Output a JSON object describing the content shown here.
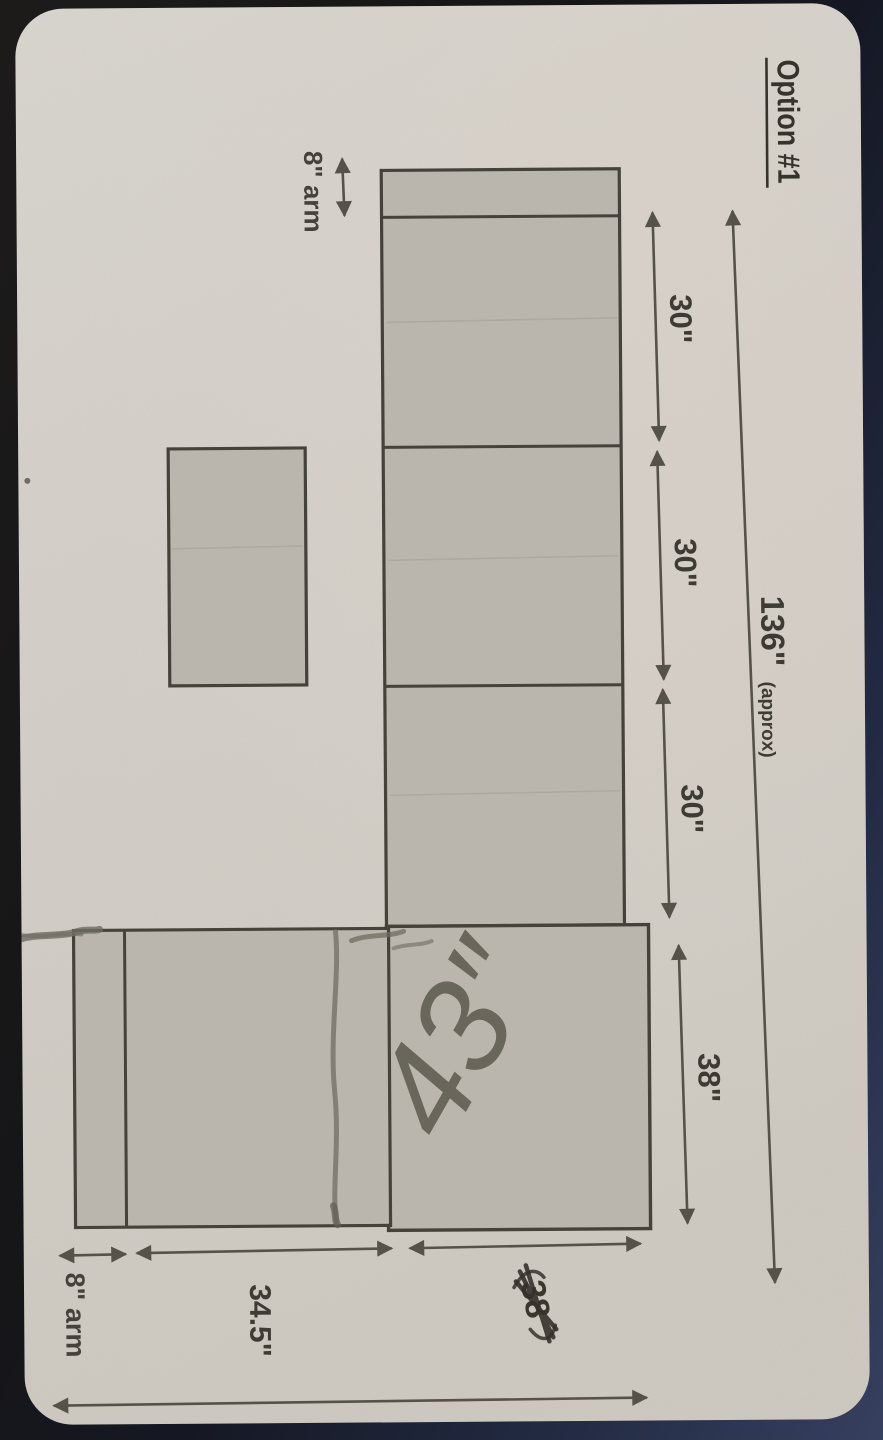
{
  "photo": {
    "title": "Option #1",
    "dimensions": {
      "arm_top": "8\" arm",
      "sections": [
        {
          "label": "30\""
        },
        {
          "label": "30\""
        },
        {
          "label": "30\""
        },
        {
          "label": "38\""
        }
      ],
      "overall_length": "136\"",
      "overall_qualifier": "(approx)",
      "arm_bottom": "8\" arm",
      "seat_bottom": "34.5\"",
      "bottom_right_crossed": "38"
    },
    "annotations": {
      "handwritten": "43″"
    },
    "colors": {
      "paper": "#d4d1ca",
      "shape_fill": "#bab6ad",
      "outline": "#45423b",
      "dimension": "#55524a",
      "pencil": "#6e6b62",
      "background_dark": "#17171a",
      "background_blue": "#36405f"
    }
  }
}
